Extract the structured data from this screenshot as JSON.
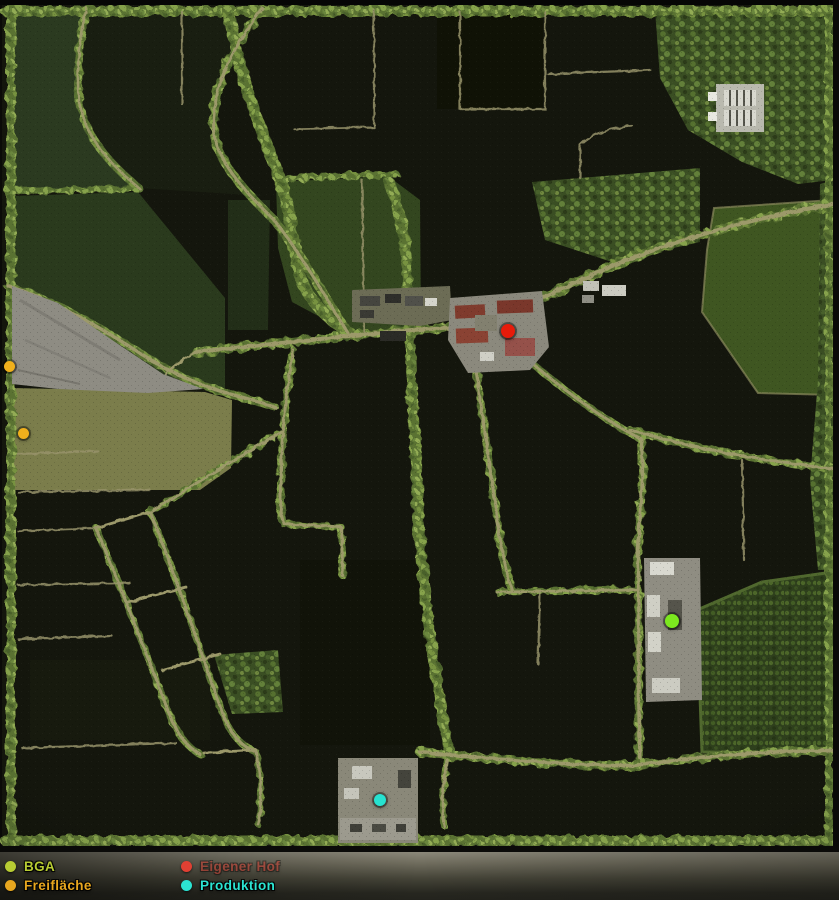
{
  "legend": {
    "items": [
      {
        "id": "bga",
        "label": "BGA",
        "color": "#b8cc33",
        "dimmed": false
      },
      {
        "id": "freiflaeche",
        "label": "Freifläche",
        "color": "#e8a71f",
        "dimmed": false
      },
      {
        "id": "eigener-hof",
        "label": "Eigener Hof",
        "color": "#e04033",
        "dimmed": true
      },
      {
        "id": "produktion",
        "label": "Produktion",
        "color": "#2ce4d2",
        "dimmed": false
      }
    ]
  },
  "map": {
    "markers": [
      {
        "type": "freiflaeche",
        "color": "#f0b01c",
        "x": 9,
        "y": 366,
        "r": 5.5
      },
      {
        "type": "freiflaeche",
        "color": "#f0b01c",
        "x": 23,
        "y": 433,
        "r": 5.5
      },
      {
        "type": "eigener-hof",
        "color": "#e71b0a",
        "x": 508,
        "y": 331,
        "r": 7
      },
      {
        "type": "bga",
        "color": "#7ce81f",
        "x": 672,
        "y": 621,
        "r": 7
      },
      {
        "type": "produktion",
        "color": "#27e2d0",
        "x": 380,
        "y": 800,
        "r": 6
      }
    ],
    "colors": {
      "field_dark": "#14160d",
      "field_green": "#33461f",
      "field_bright": "#3f5621",
      "road": "#9c996a",
      "trees": "#5a7233",
      "quarry": "#8e8c83",
      "farm_roof": "#7f3b2d"
    }
  }
}
